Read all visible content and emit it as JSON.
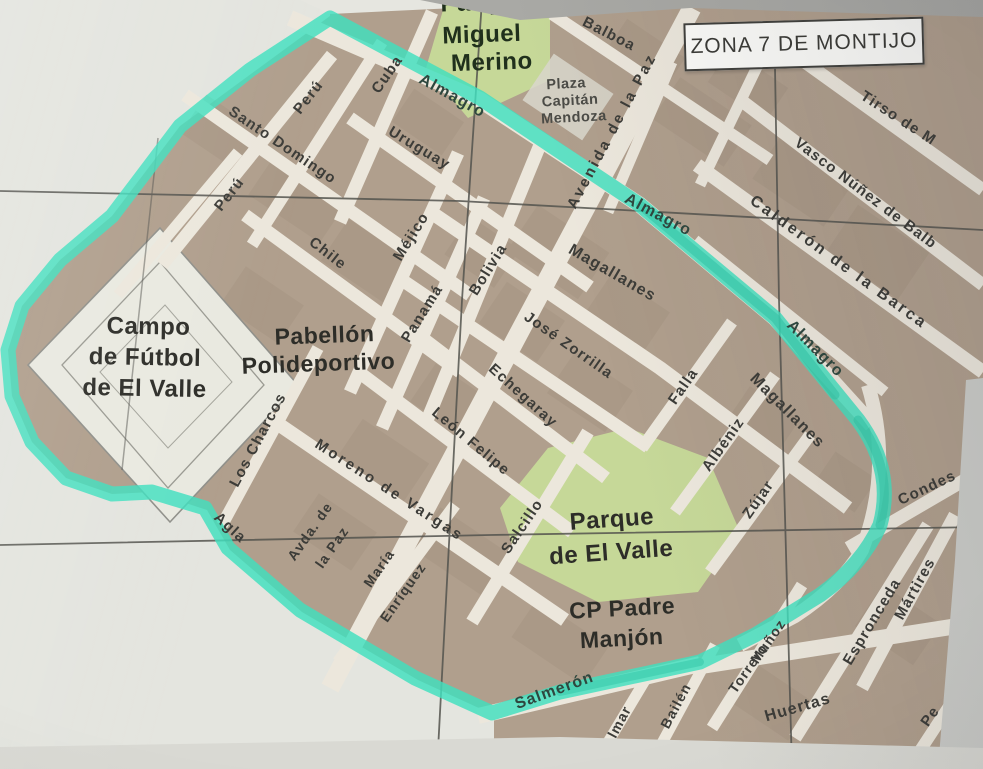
{
  "title_box": {
    "label": "ZONA 7 DE MONTIJO"
  },
  "places": {
    "parque_miguel_merino": {
      "lines": [
        "Parque",
        "Miguel",
        "Merino"
      ]
    },
    "plaza_capitan_mendoza": {
      "lines": [
        "Plaza",
        "Capitán",
        "Mendoza"
      ]
    },
    "campo_futbol": {
      "lines": [
        "Campo",
        "de Fútbol",
        "de El Valle"
      ]
    },
    "pabellon_polideportivo": {
      "lines": [
        "Pabellón",
        "Polideportivo"
      ]
    },
    "parque_el_valle": {
      "lines": [
        "Parque",
        "de El Valle"
      ]
    },
    "cp_padre_manjon": {
      "lines": [
        "CP Padre",
        "Manjón"
      ]
    }
  },
  "street_labels": {
    "almagro_1": "Almagro",
    "almagro_2": "Almagro",
    "almagro_3": "Almagro",
    "santo_domingo": "Santo Domingo",
    "peru_1": "Perú",
    "peru_2": "Perú",
    "cuba": "Cuba",
    "uruguay": "Uruguay",
    "chile": "Chile",
    "mejico": "Méjico",
    "panama": "Panamá",
    "bolivia": "Bolivia",
    "balboa": "Balboa",
    "avenida_de_la_paz": "Avenida de la Paz",
    "tirso_de_m": "Tirso de M",
    "vasco_nunez": "Vasco Núñez de Balb",
    "calderon": "Calderón de la Barca",
    "magallanes_1": "Magallanes",
    "magallanes_2": "Magallanes",
    "jose_zorrilla": "José Zorrilla",
    "echegaray": "Echegaray",
    "leon_felipe": "León Felipe",
    "salcillo": "Salcillo",
    "falla": "Falla",
    "albeniz": "Albéniz",
    "zujar": "Zújar",
    "condes": "Condes",
    "martires": "Mártires",
    "espronceda": "Espronceda",
    "los_charcos": "Los Charcos",
    "moreno_de_vargas": "Moreno de Vargas",
    "avda_de": "Avda. de",
    "la_paz": "la Paz",
    "maria": "María",
    "enriquez": "Enríquez",
    "agla": "Agla",
    "salmeron": "Salmerón",
    "almar": "Almar",
    "bailen": "Bailén",
    "munoz": "Muñoz",
    "torrero": "Torrero",
    "huertas": "Huertas",
    "pe": "Pe",
    "ma": "Má"
  },
  "colors": {
    "zone_highlight": "#3fdfbe",
    "zone_highlight_dark": "#2cc4a4",
    "park_green": "#c6d898",
    "street_white": "#ece7dc",
    "block_tan": "#b09f8d",
    "grid_line": "#53534e",
    "label_dark": "#3c3c38"
  }
}
